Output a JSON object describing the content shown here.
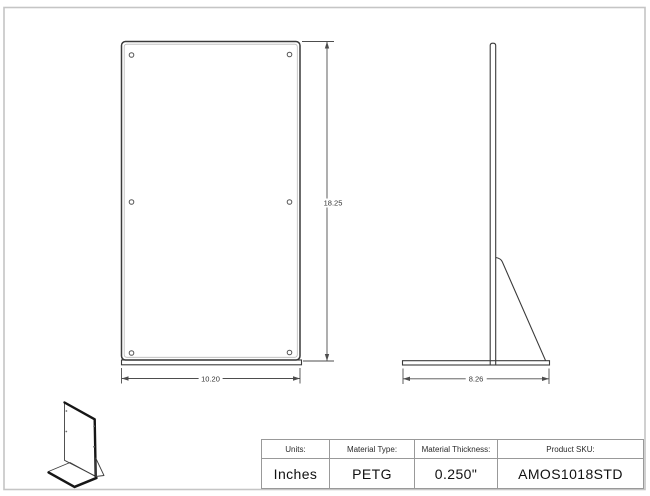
{
  "colors": {
    "line": "#3a3a3a",
    "inner_line": "#b9b9b9",
    "dim_line": "#4d4d4d",
    "frame_border": "#c5c5c5",
    "table_border": "#999999",
    "text": "#1a1a1a",
    "background": "#ffffff"
  },
  "drawing": {
    "front_view": {
      "height_label": "18.25",
      "width_label": "10.20"
    },
    "side_view": {
      "depth_label": "8.26"
    }
  },
  "spec_table": {
    "columns": [
      {
        "header": "Units:",
        "value": "Inches"
      },
      {
        "header": "Material Type:",
        "value": "PETG"
      },
      {
        "header": "Material Thickness:",
        "value": "0.250\""
      },
      {
        "header": "Product SKU:",
        "value": "AMOS1018STD"
      }
    ]
  }
}
